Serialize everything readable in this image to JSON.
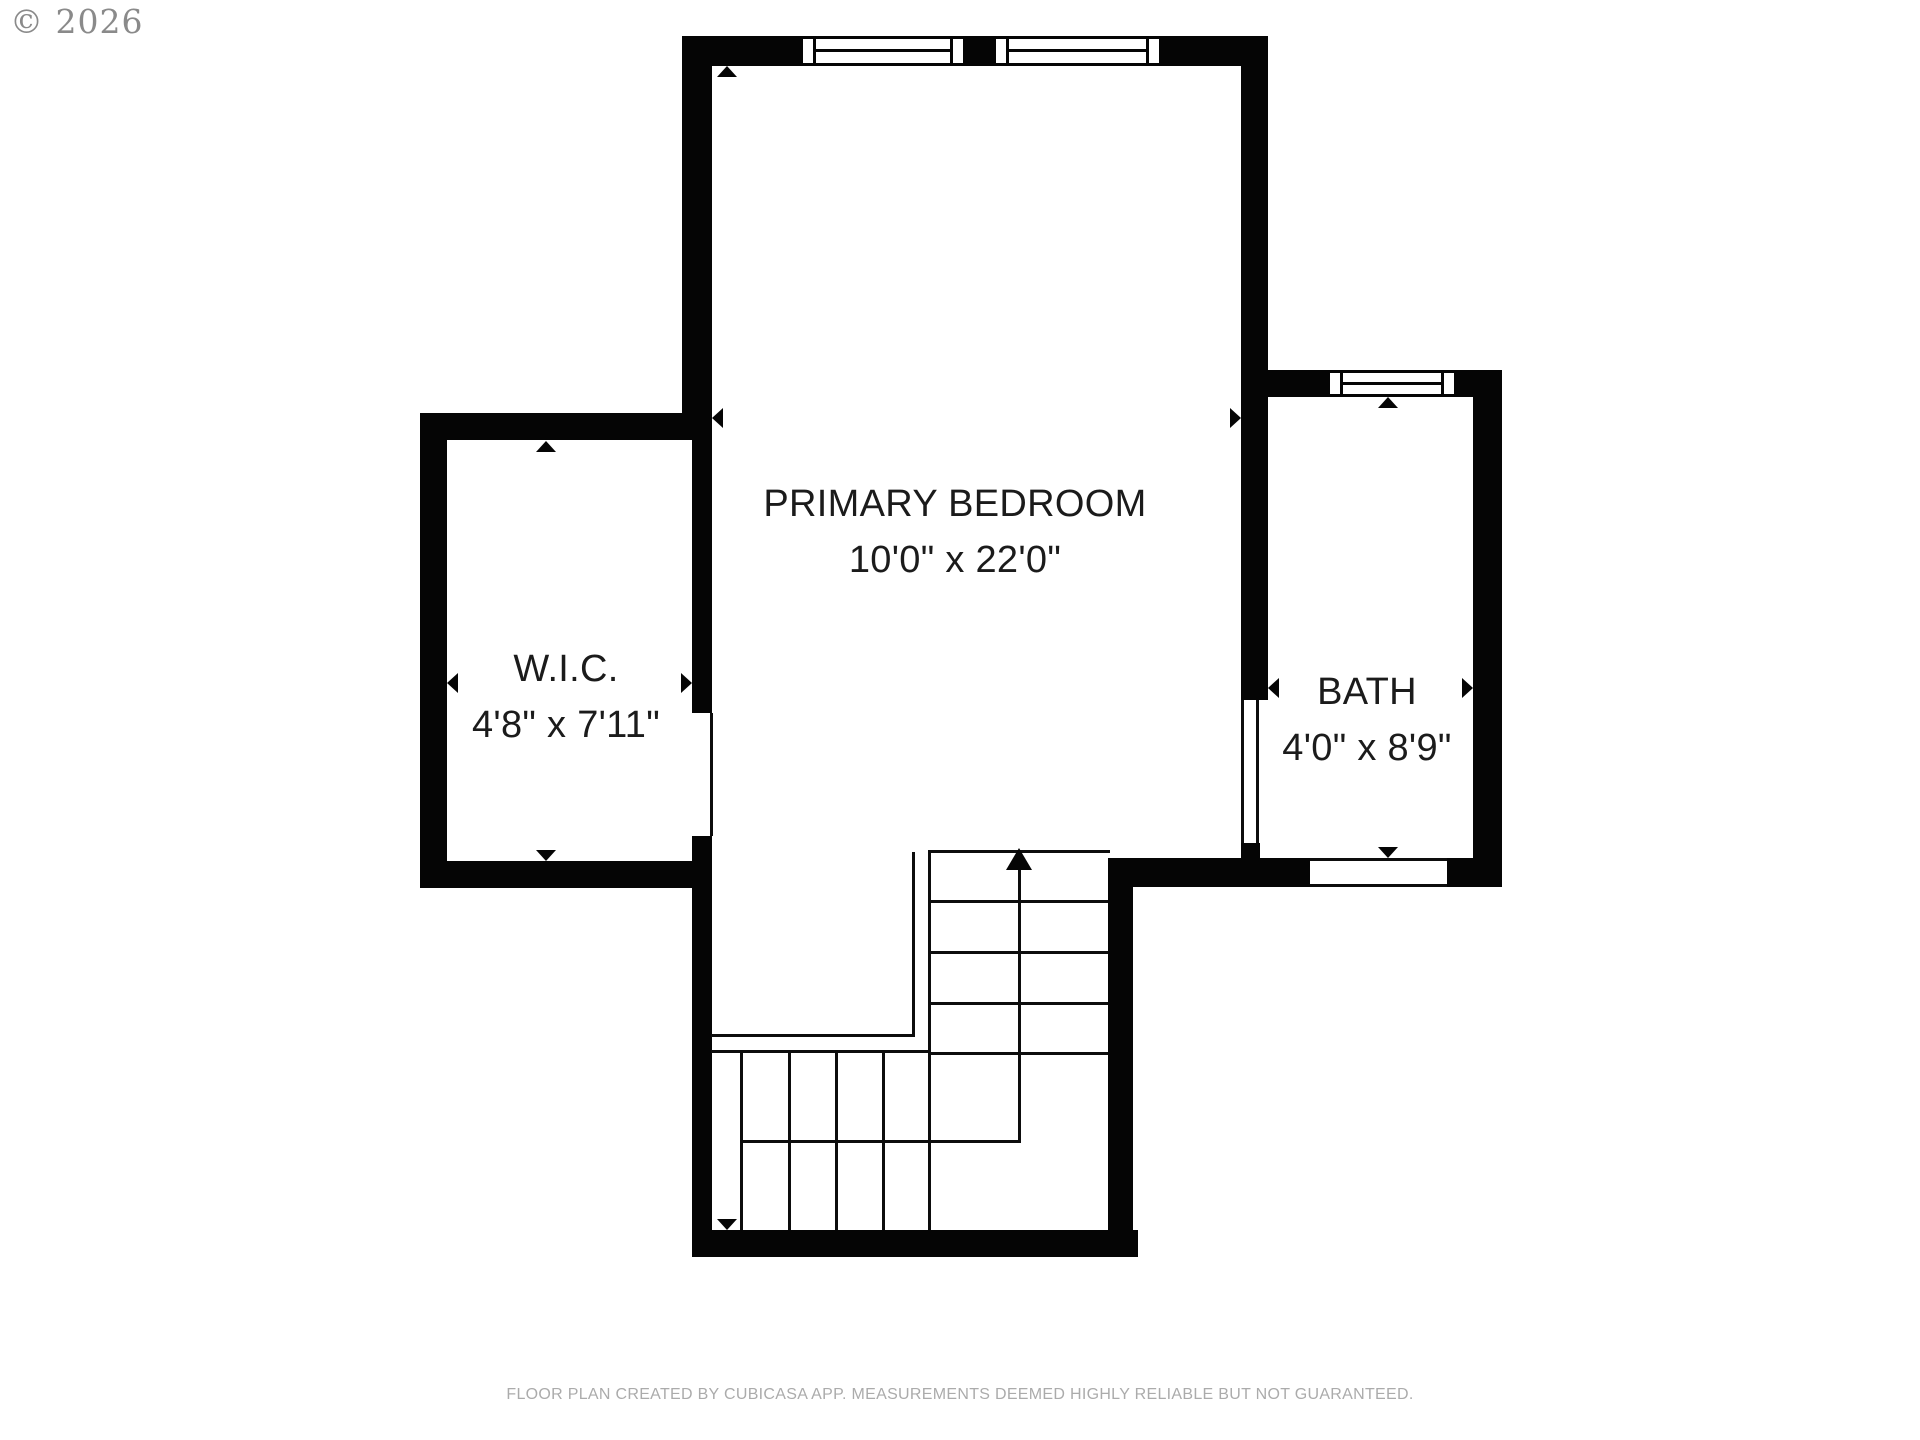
{
  "watermark": {
    "text": "© 2026"
  },
  "footer": {
    "text": "FLOOR PLAN CREATED BY CUBICASA APP. MEASUREMENTS DEEMED HIGHLY RELIABLE BUT NOT GUARANTEED."
  },
  "colors": {
    "wall": "#050505",
    "label_text": "#1b1b1b",
    "footer_text": "#ababab",
    "watermark_text": "#8a8a8a",
    "background": "#ffffff"
  },
  "rooms": [
    {
      "name": "PRIMARY BEDROOM",
      "dims": "10'0\" x 22'0\""
    },
    {
      "name": "W.I.C.",
      "dims": "4'8\" x 7'11\""
    },
    {
      "name": "BATH",
      "dims": "4'0\" x 8'9\""
    }
  ],
  "floorplan": {
    "walls": [
      [
        682,
        36,
        118,
        30
      ],
      [
        966,
        36,
        27,
        30
      ],
      [
        1162,
        36,
        106,
        30
      ],
      [
        682,
        36,
        30,
        404
      ],
      [
        692,
        440,
        20,
        273
      ],
      [
        692,
        836,
        20,
        421
      ],
      [
        420,
        413,
        292,
        27
      ],
      [
        420,
        413,
        27,
        475
      ],
      [
        420,
        861,
        292,
        27
      ],
      [
        692,
        1230,
        446,
        27
      ],
      [
        1108,
        858,
        25,
        399
      ],
      [
        1108,
        858,
        202,
        29
      ],
      [
        1447,
        858,
        55,
        29
      ],
      [
        1241,
        36,
        27,
        664
      ],
      [
        1241,
        843,
        19,
        44
      ],
      [
        1268,
        370,
        59,
        27
      ],
      [
        1457,
        370,
        45,
        27
      ],
      [
        1473,
        370,
        29,
        517
      ]
    ],
    "windows": [
      [
        800,
        36,
        166,
        30
      ],
      [
        993,
        36,
        169,
        30
      ],
      [
        1327,
        370,
        130,
        27
      ]
    ],
    "opening_lines": [
      [
        710,
        713,
        3,
        123
      ],
      [
        1241,
        700,
        3,
        143
      ],
      [
        1256,
        700,
        3,
        143
      ],
      [
        1310,
        858,
        137,
        3
      ],
      [
        1310,
        884,
        137,
        3
      ]
    ],
    "stair_lines": [
      [
        928,
        850,
        182,
        3
      ],
      [
        912,
        852,
        3,
        185
      ],
      [
        928,
        850,
        3,
        380
      ],
      [
        711,
        1034,
        204,
        3
      ],
      [
        711,
        1050,
        220,
        3
      ],
      [
        931,
        900,
        177,
        3
      ],
      [
        931,
        951,
        177,
        3
      ],
      [
        931,
        1002,
        177,
        3
      ],
      [
        931,
        1052,
        177,
        3
      ],
      [
        740,
        1052,
        3,
        178
      ],
      [
        788,
        1052,
        3,
        178
      ],
      [
        835,
        1052,
        3,
        178
      ],
      [
        882,
        1052,
        3,
        178
      ],
      [
        740,
        1140,
        280,
        3
      ],
      [
        1018,
        870,
        3,
        273
      ]
    ],
    "stair_arrowhead": {
      "x": 1019,
      "y": 848
    },
    "measure_arrows": [
      {
        "x": 727,
        "y": 66,
        "dir": "up"
      },
      {
        "x": 727,
        "y": 1230,
        "dir": "down"
      },
      {
        "x": 712,
        "y": 418,
        "dir": "left"
      },
      {
        "x": 1241,
        "y": 418,
        "dir": "right"
      },
      {
        "x": 546,
        "y": 441,
        "dir": "up"
      },
      {
        "x": 546,
        "y": 861,
        "dir": "down"
      },
      {
        "x": 447,
        "y": 683,
        "dir": "left"
      },
      {
        "x": 692,
        "y": 683,
        "dir": "right"
      },
      {
        "x": 1388,
        "y": 397,
        "dir": "up"
      },
      {
        "x": 1388,
        "y": 858,
        "dir": "down"
      },
      {
        "x": 1268,
        "y": 688,
        "dir": "left"
      },
      {
        "x": 1473,
        "y": 688,
        "dir": "right"
      }
    ]
  }
}
